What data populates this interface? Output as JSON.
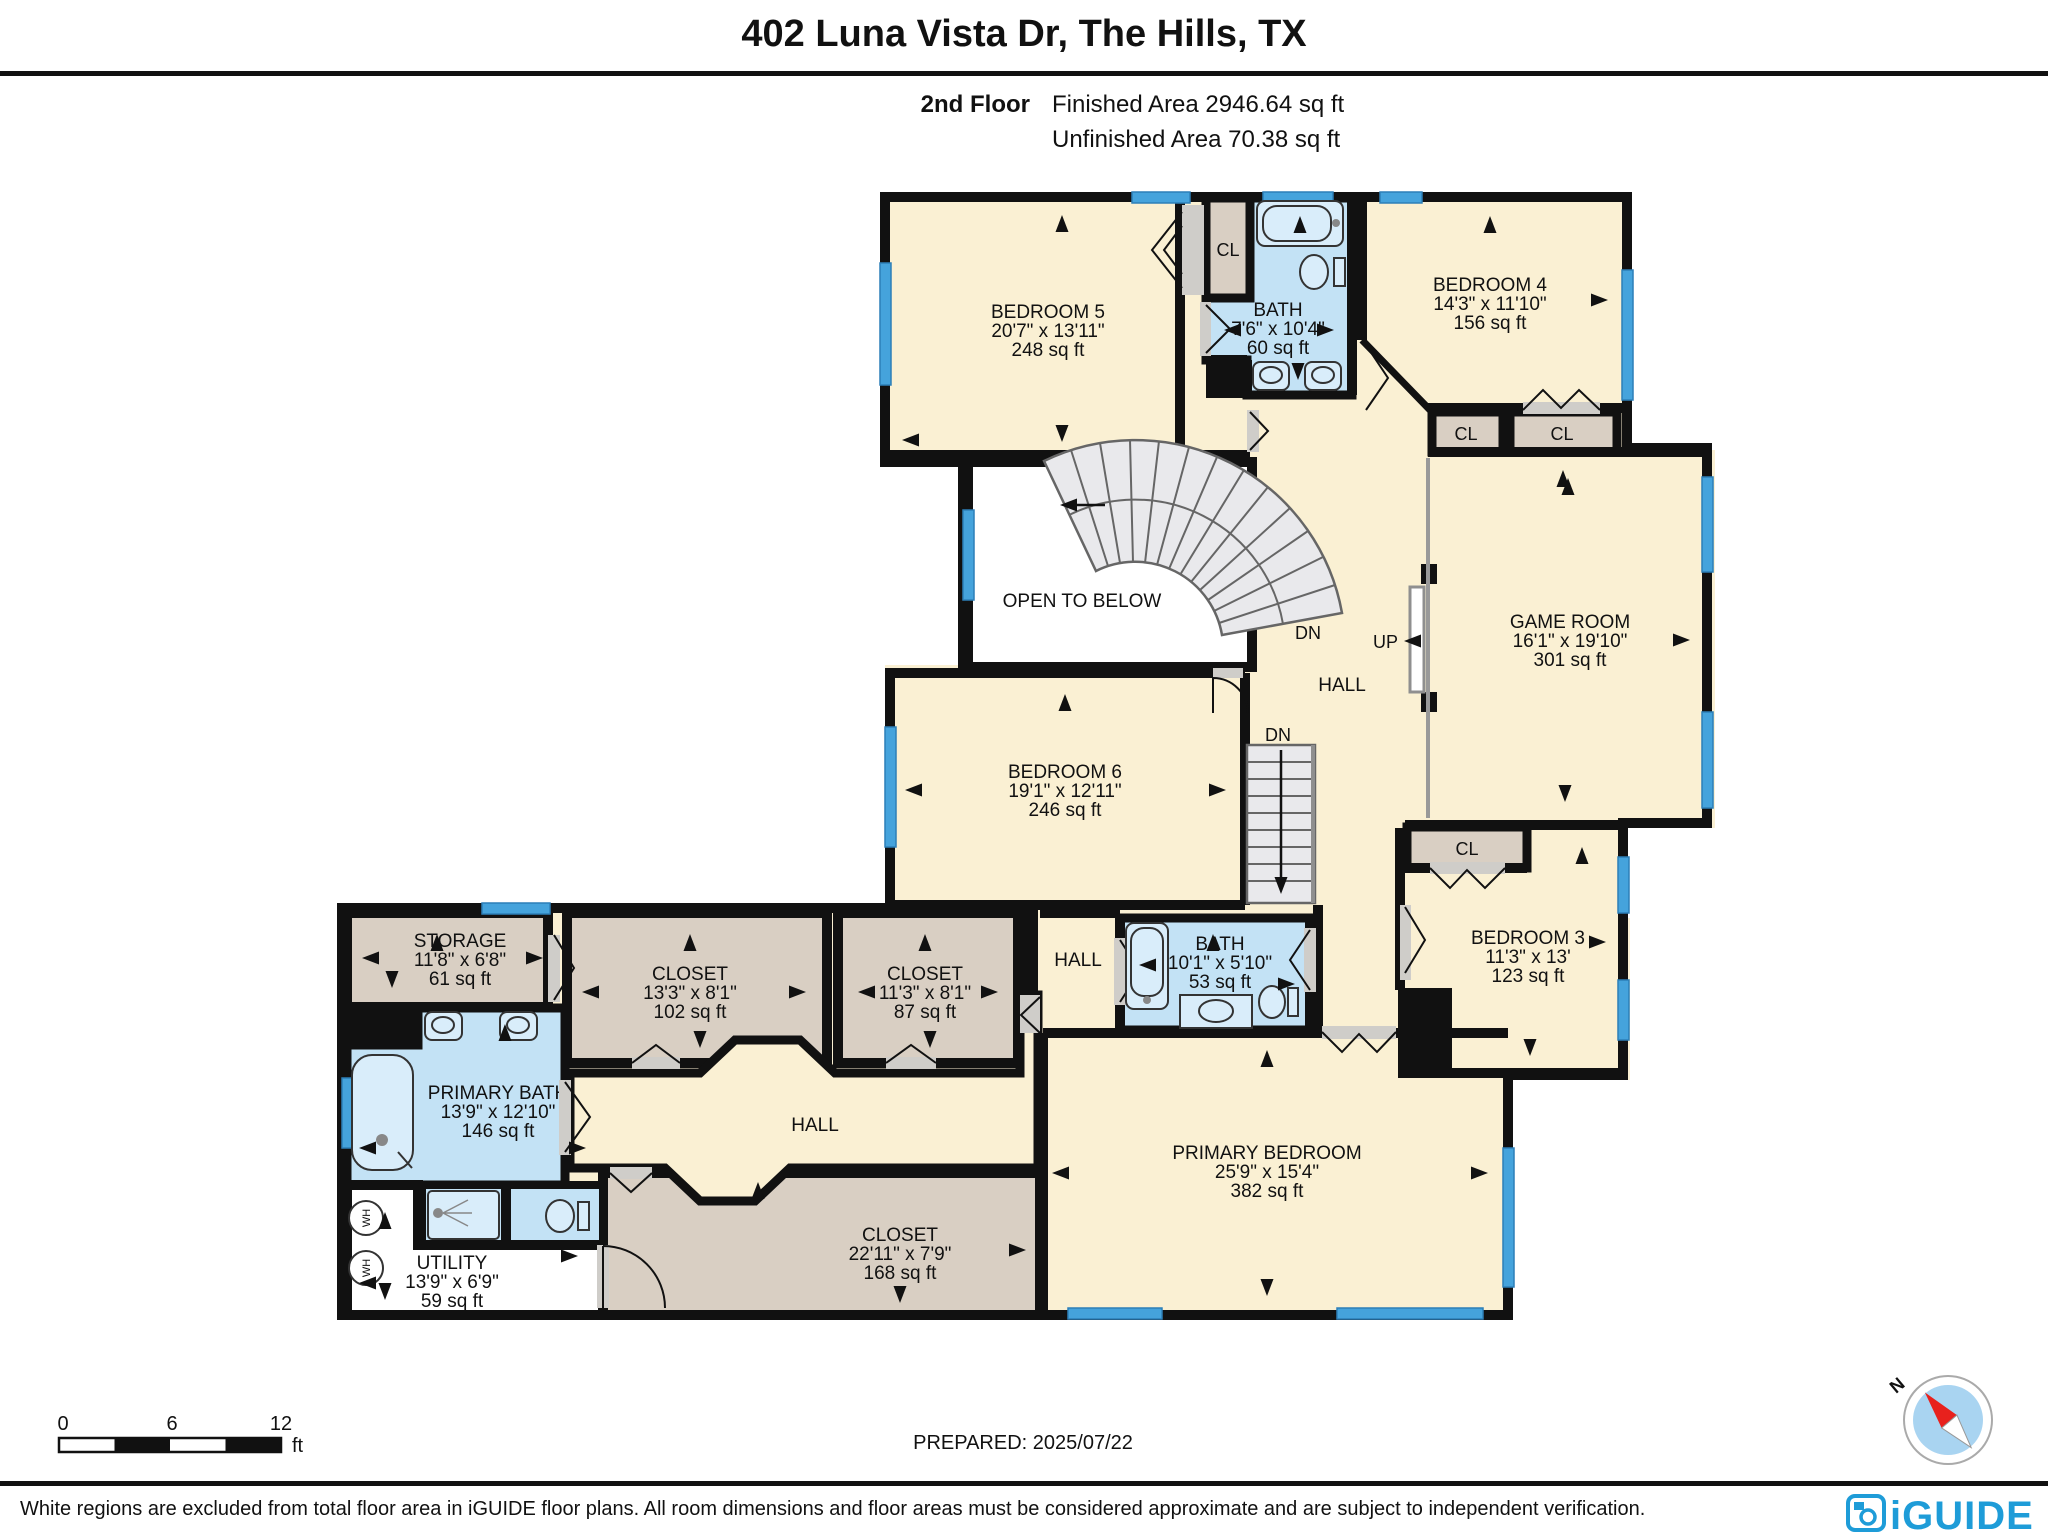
{
  "header": {
    "title": "402 Luna Vista Dr, The Hills, TX",
    "floor_label": "2nd Floor",
    "finished_area": "Finished Area 2946.64 sq ft",
    "unfinished_area": "Unfinished Area 70.38 sq ft"
  },
  "rooms": {
    "bedroom5": {
      "name": "BEDROOM 5",
      "dims": "20'7\" x 13'11\"",
      "area": "248 sq ft"
    },
    "bath_top": {
      "name": "BATH",
      "dims": "7'6\" x 10'4\"",
      "area": "60 sq ft"
    },
    "bedroom4": {
      "name": "BEDROOM 4",
      "dims": "14'3\" x 11'10\"",
      "area": "156 sq ft"
    },
    "game_room": {
      "name": "GAME ROOM",
      "dims": "16'1\" x 19'10\"",
      "area": "301 sq ft"
    },
    "bedroom6": {
      "name": "BEDROOM 6",
      "dims": "19'1\" x 12'11\"",
      "area": "246 sq ft"
    },
    "bedroom3": {
      "name": "BEDROOM 3",
      "dims": "11'3\" x 13'",
      "area": "123 sq ft"
    },
    "storage": {
      "name": "STORAGE",
      "dims": "11'8\" x 6'8\"",
      "area": "61 sq ft"
    },
    "closet_a": {
      "name": "CLOSET",
      "dims": "13'3\" x 8'1\"",
      "area": "102 sq ft"
    },
    "closet_b": {
      "name": "CLOSET",
      "dims": "11'3\" x 8'1\"",
      "area": "87 sq ft"
    },
    "bath2": {
      "name": "BATH",
      "dims": "10'1\" x 5'10\"",
      "area": "53 sq ft"
    },
    "primary_bath": {
      "name": "PRIMARY BATH",
      "dims": "13'9\" x 12'10\"",
      "area": "146 sq ft"
    },
    "closet_primary": {
      "name": "CLOSET",
      "dims": "22'11\" x 7'9\"",
      "area": "168 sq ft"
    },
    "utility": {
      "name": "UTILITY",
      "dims": "13'9\" x 6'9\"",
      "area": "59 sq ft"
    },
    "primary_bedroom": {
      "name": "PRIMARY BEDROOM",
      "dims": "25'9\" x 15'4\"",
      "area": "382 sq ft"
    }
  },
  "labels": {
    "open_to_below": "OPEN TO BELOW",
    "hall": "HALL",
    "up": "UP",
    "dn": "DN",
    "cl": "CL",
    "wh": "WH"
  },
  "scale_bar": {
    "t0": "0",
    "t6": "6",
    "t12": "12",
    "unit": "ft"
  },
  "footer": {
    "prepared": "PREPARED: 2025/07/22",
    "disclaimer": "White regions are excluded from total floor area in iGUIDE floor plans. All room dimensions and floor areas must be considered approximate and are subject to independent verification.",
    "brand": "iGUIDE",
    "north": "N"
  },
  "colors": {
    "finished": "#FAF0D3",
    "closet": "#D9CFC3",
    "bath": "#C3E2F5",
    "window": "#45A3DC",
    "wall": "#111111",
    "stair": "#E9E9EC",
    "brand_blue": "#1E9CD8",
    "compass_red": "#E8211D"
  }
}
